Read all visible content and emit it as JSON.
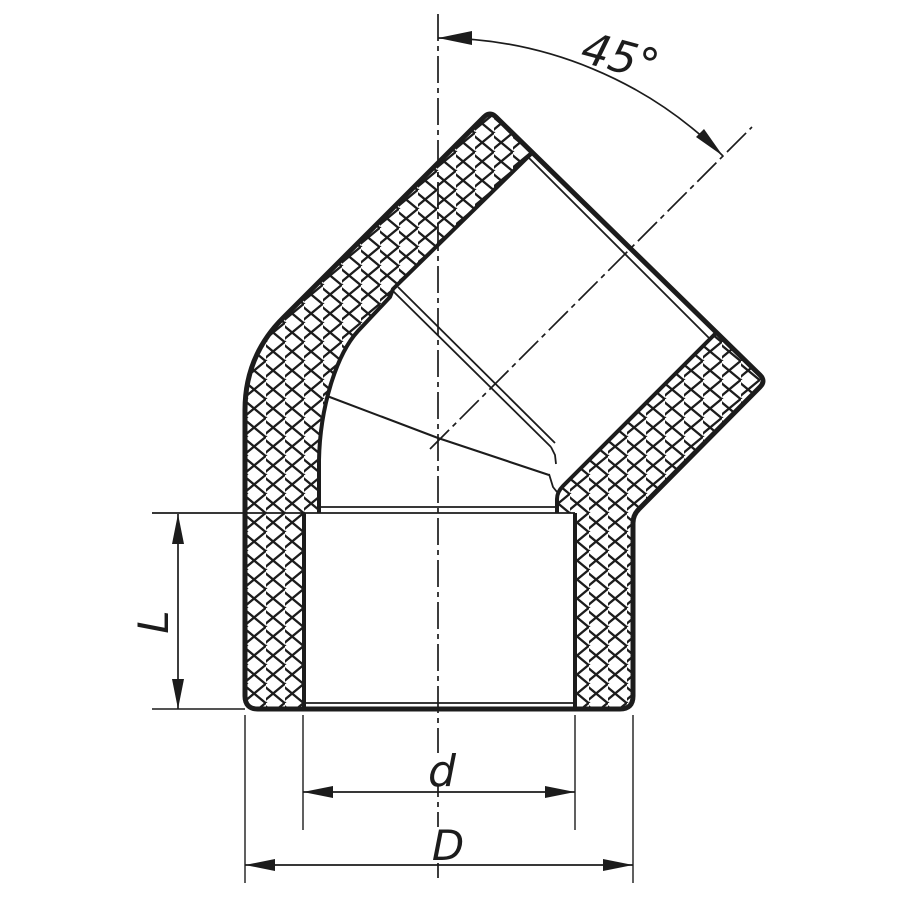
{
  "drawing": {
    "subject": "45-degree elbow pipe fitting cross-section",
    "labels": {
      "angle": "45°",
      "socket_depth": "L",
      "inner_diameter": "d",
      "outer_diameter": "D"
    },
    "colors": {
      "ink": "#1c1c1c",
      "background": "#ffffff"
    }
  }
}
